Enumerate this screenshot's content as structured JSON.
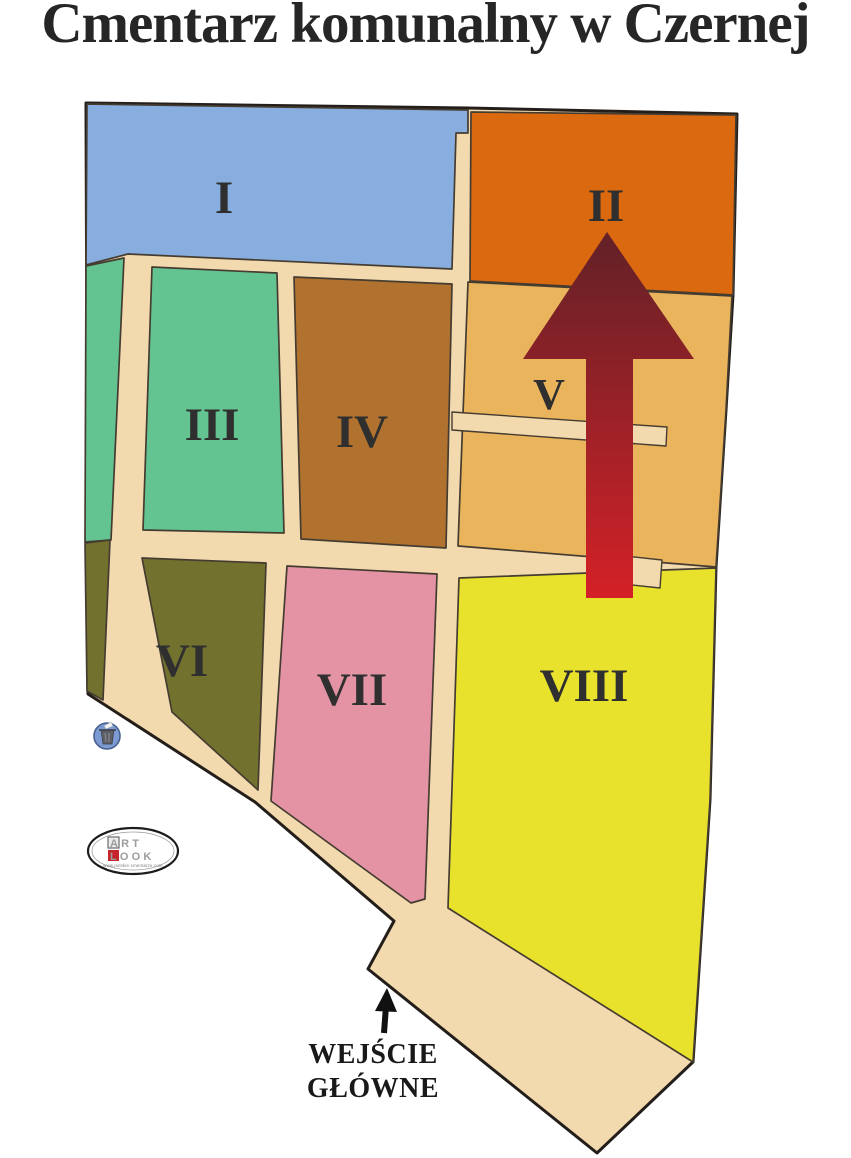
{
  "title": "Cmentarz komunalny w Czernej",
  "map": {
    "path_color": "#f3d9ae",
    "outline_color": "#231e19",
    "section_border_color": "#453c31",
    "sections": [
      {
        "id": "I",
        "label": "I",
        "color": "#87aede"
      },
      {
        "id": "II",
        "label": "II",
        "color": "#db690f"
      },
      {
        "id": "III",
        "label": "III",
        "color": "#63c492"
      },
      {
        "id": "IV",
        "label": "IV",
        "color": "#b0722e"
      },
      {
        "id": "V",
        "label": "V",
        "color": "#eab45c"
      },
      {
        "id": "VI",
        "label": "VI",
        "color": "#72712e"
      },
      {
        "id": "VII",
        "label": "VII",
        "color": "#e393a3"
      },
      {
        "id": "VIII",
        "label": "VIII",
        "color": "#e9e22c"
      }
    ]
  },
  "north_arrow": {
    "icon": "north-arrow",
    "color_top": "#622127",
    "color_bottom": "#d42127"
  },
  "entrance": {
    "line1": "WEJŚCIE",
    "line2": "GŁÓWNE",
    "arrow_icon": "up-arrow"
  },
  "icons": {
    "trash_bin": "🗑",
    "north_arrow": "▲",
    "entrance_arrow": "↑"
  },
  "logo": {
    "line1": "ART",
    "line2": "LOOK",
    "url": "www.polskie-cmentarze.com",
    "accent_color": "#c6242b"
  }
}
